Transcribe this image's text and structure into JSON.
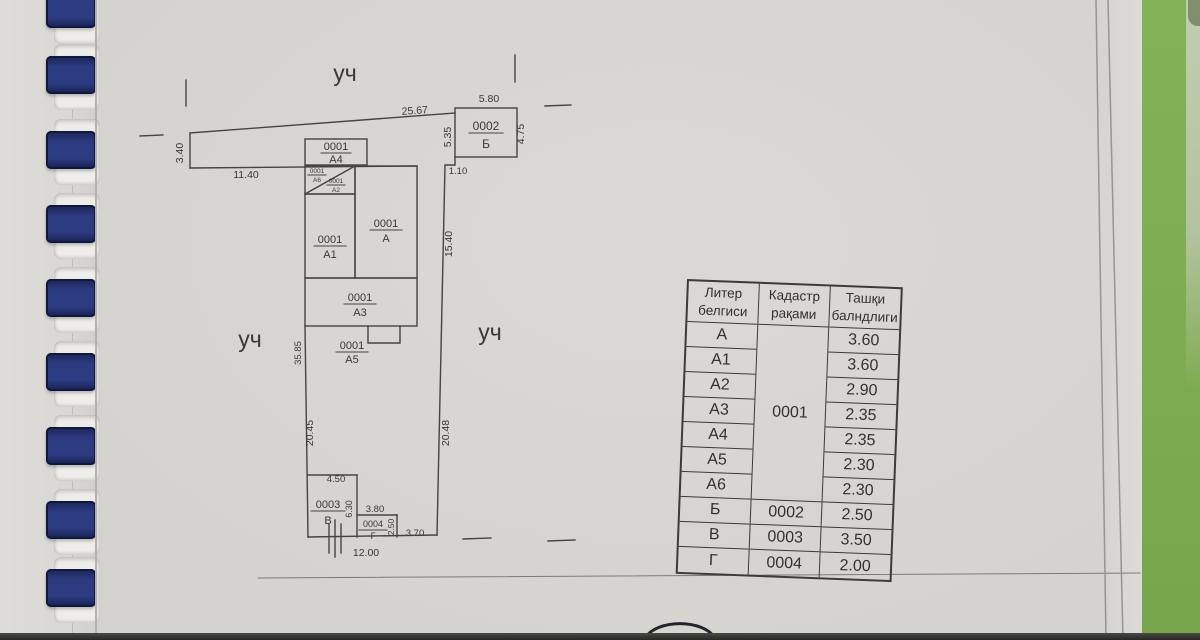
{
  "document": {
    "plot_labels": {
      "top": "уч",
      "left": "уч",
      "right": "уч"
    },
    "dimensions": {
      "strip_top": "25.67",
      "strip_left": "3.40",
      "strip_bottom": "11.40",
      "b_top": "5.80",
      "b_left": "5.35",
      "b_right": "4.75",
      "step": "1.10",
      "right_upper": "15.40",
      "left_upper": "35.85",
      "left_lower": "20.45",
      "right_lower": "20.48",
      "v_top": "4.50",
      "v_right": "6.30",
      "g_top": "3.80",
      "g_right": "2.50",
      "bottom_right_seg": "3.70",
      "bottom": "12.00"
    },
    "units": {
      "a4": {
        "code": "0001",
        "letter": "А4"
      },
      "a6": {
        "code": "0001",
        "letter": "А6"
      },
      "a2": {
        "code": "0001",
        "letter": "А2"
      },
      "a1": {
        "code": "0001",
        "letter": "А1"
      },
      "a": {
        "code": "0001",
        "letter": "А"
      },
      "a3": {
        "code": "0001",
        "letter": "А3"
      },
      "a5": {
        "code": "0001",
        "letter": "А5"
      },
      "b": {
        "code": "0002",
        "letter": "Б"
      },
      "v": {
        "code": "0003",
        "letter": "В"
      },
      "g": {
        "code": "0004",
        "letter": "Г"
      }
    },
    "table": {
      "headers": [
        [
          "Литер",
          "белгиси"
        ],
        [
          "Кадастр",
          "рақами"
        ],
        [
          "Ташқи",
          "балндлиги"
        ]
      ],
      "merged_code": "0001",
      "rows": [
        {
          "liter": "А",
          "code": "",
          "height": "3.60"
        },
        {
          "liter": "А1",
          "code": "",
          "height": "3.60"
        },
        {
          "liter": "А2",
          "code": "",
          "height": "2.90"
        },
        {
          "liter": "А3",
          "code": "",
          "height": "2.35"
        },
        {
          "liter": "А4",
          "code": "",
          "height": "2.35"
        },
        {
          "liter": "А5",
          "code": "",
          "height": "2.30"
        },
        {
          "liter": "А6",
          "code": "",
          "height": "2.30"
        },
        {
          "liter": "Б",
          "code": "0002",
          "height": "2.50"
        },
        {
          "liter": "В",
          "code": "0003",
          "height": "3.50"
        },
        {
          "liter": "Г",
          "code": "0004",
          "height": "2.00"
        }
      ]
    },
    "colors": {
      "binder_ring": "#2c3b80",
      "desk_green": "#7fae52",
      "page": "#d6d4cf"
    }
  }
}
